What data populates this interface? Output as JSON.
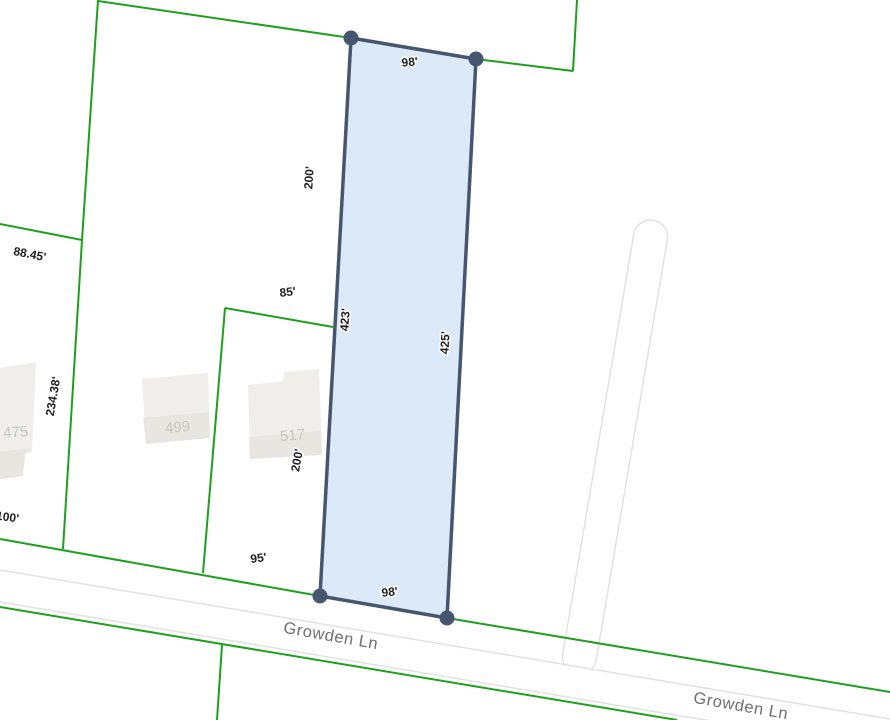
{
  "map": {
    "street_labels": [
      {
        "text": "Growden Ln"
      },
      {
        "text": "Growden Ln"
      }
    ],
    "selected_parcel": {
      "dimensions": {
        "top": "98'",
        "left": "423'",
        "right": "425'",
        "bottom": "98'"
      }
    },
    "dimension_labels": [
      {
        "id": "selected-top-width",
        "text": "98'"
      },
      {
        "id": "neighbor-depth-upper",
        "text": "200'"
      },
      {
        "id": "neighbor-width-85",
        "text": "85'"
      },
      {
        "id": "neighbor-width-88-45",
        "text": "88.45'"
      },
      {
        "id": "selected-left-depth",
        "text": "423'"
      },
      {
        "id": "selected-right-depth",
        "text": "425'"
      },
      {
        "id": "neighbor-depth-234-38",
        "text": "234.38'"
      },
      {
        "id": "neighbor-width-100",
        "text": "100'"
      },
      {
        "id": "neighbor-depth-lower",
        "text": "200'"
      },
      {
        "id": "neighbor-width-95",
        "text": "95'"
      },
      {
        "id": "selected-bottom-width",
        "text": "98'"
      }
    ],
    "building_labels": [
      {
        "text": "475"
      },
      {
        "text": "499"
      },
      {
        "text": "517"
      }
    ],
    "colors": {
      "boundary_green": "#1da01d",
      "parcel_fill": "#d9e8f9",
      "parcel_stroke": "#46566f",
      "road_edge": "#e2e2e2",
      "road_fill": "#ffffff",
      "dimension_text": "#1f1f1f",
      "street_text": "#6e6e6e",
      "building_fill": "#f0eeeb",
      "building_fill_shade": "#e9e6e2",
      "building_text": "#c8c5c1",
      "background": "#ffffff"
    }
  }
}
